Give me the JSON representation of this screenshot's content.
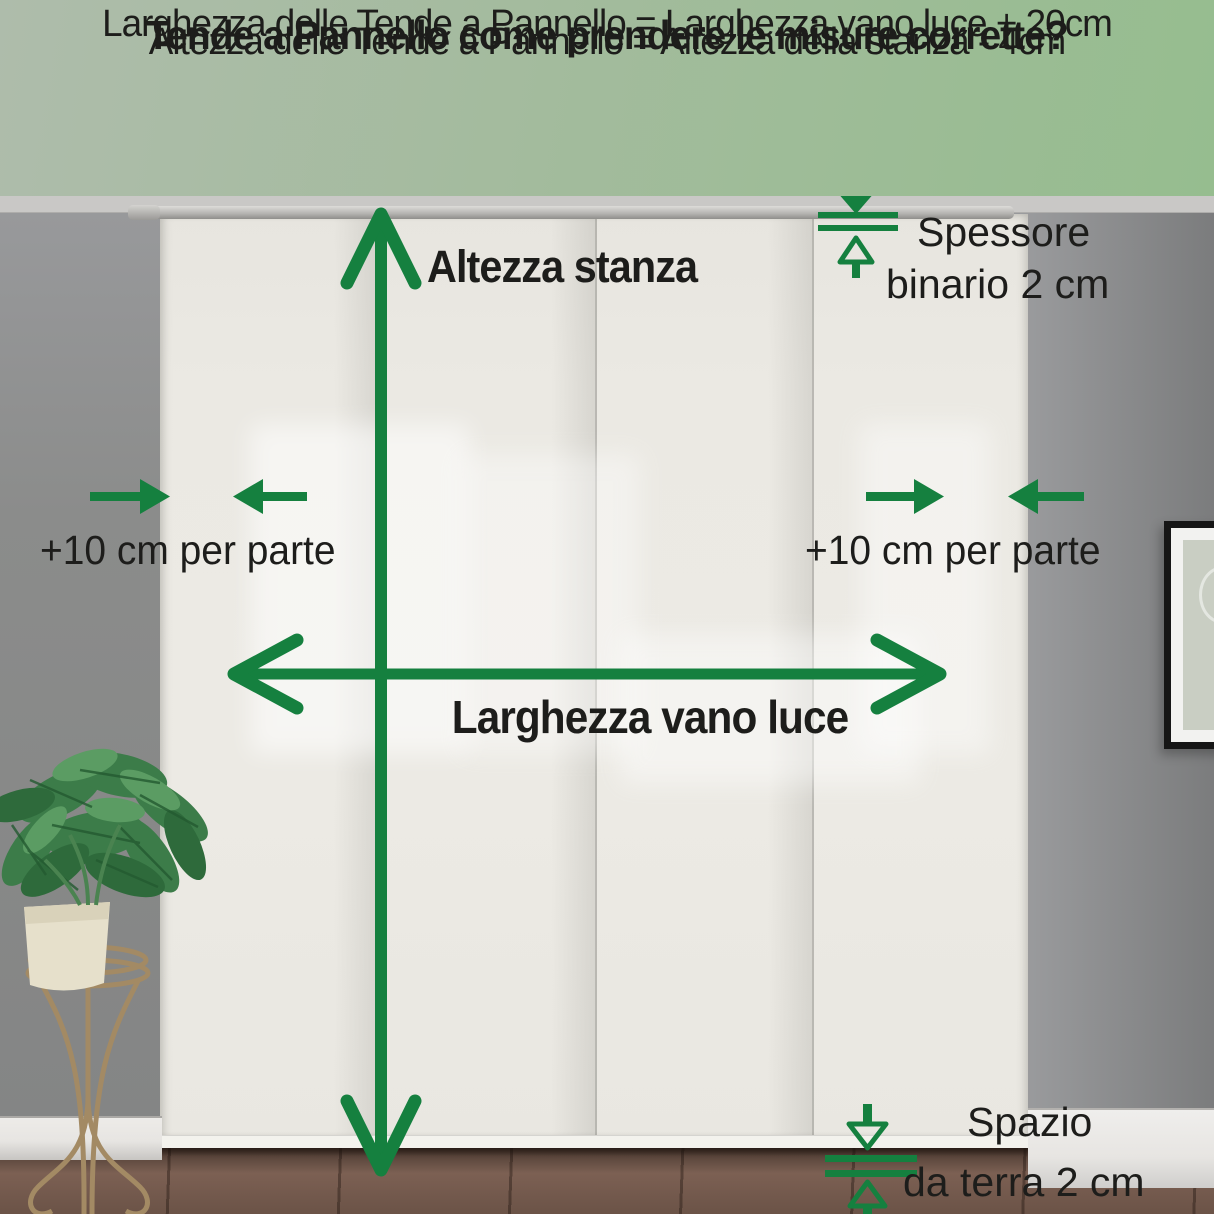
{
  "header": {
    "title": "Tende a Pannello come prendere le misure corrette?",
    "formula_height": "Altezza delle Tende a Pannello = Altezza della stanza - 4cm",
    "formula_width": "Larghezza delle Tende a Pannello = Larghezza vano luce + 20cm"
  },
  "labels": {
    "room_height": "Altezza stanza",
    "opening_width": "Larghezza vano luce",
    "left_offset": "+10 cm per parte",
    "right_offset": "+10 cm per parte",
    "track_line1": "Spessore",
    "track_line2": "binario 2 cm",
    "floor_gap_line1": "Spazio",
    "floor_gap_line2": "da terra 2 cm"
  },
  "colors": {
    "green": "#15803f",
    "header-bg-left": "#aebcab",
    "header-bg-right": "#96bd8f",
    "text": "#1d1d1b",
    "ceiling": "#c9c8c6",
    "wall-left": "#8b8c8b",
    "wall-right-light": "#9b9c9e",
    "wall-right-dark": "#7b7c7d",
    "curtain": "#ebe9e3",
    "rail": "#b7b6b3",
    "floor": "#6b5347",
    "baseboard": "#e7e5e2"
  }
}
